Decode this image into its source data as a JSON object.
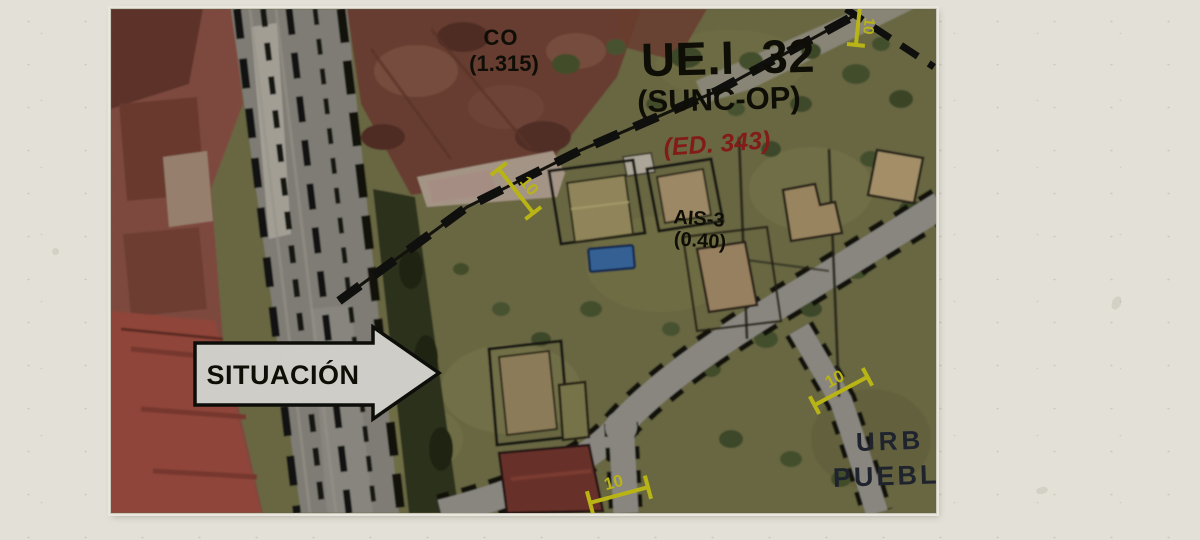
{
  "map": {
    "labels": {
      "co": {
        "line1": "CO",
        "line2": "(1.315)"
      },
      "title": "UE.I .32",
      "subtitle": "(SUNC-OP)",
      "ed_ref": "(ED. 343)",
      "ais": {
        "line1": "AIS-3",
        "line2": "(0.40)"
      },
      "partial_place": {
        "line1": "URB",
        "line2": "PUEBL"
      }
    },
    "dimension_marker_value": "10",
    "situacion_arrow_label": "SITUACIÓN",
    "colors": {
      "accent_yellow": "#ded81a",
      "label_red": "#9c221c",
      "label_black": "#111108",
      "partial_navy": "#242b38",
      "arrow_fill": "#f7f6ef"
    }
  }
}
